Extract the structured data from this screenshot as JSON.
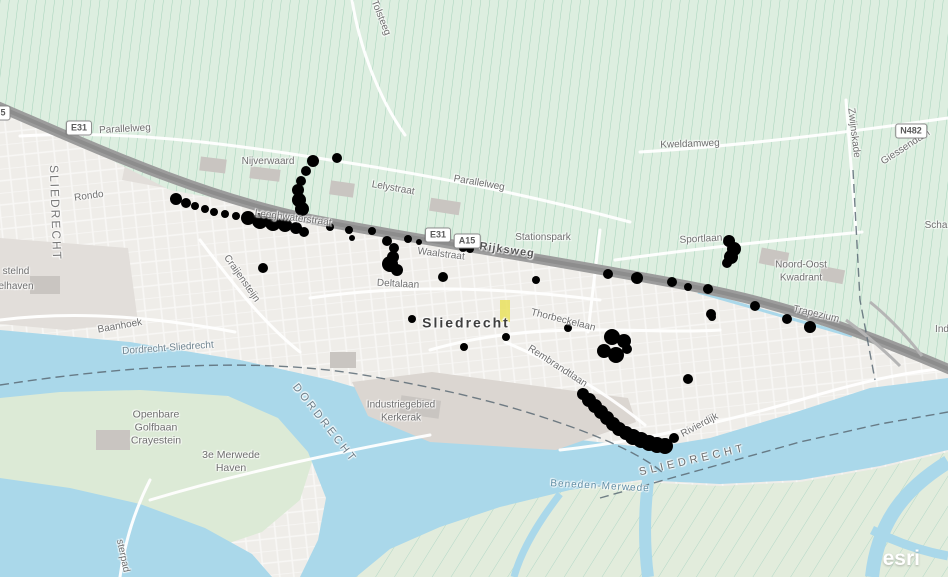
{
  "map": {
    "attribution": "esri",
    "colors": {
      "urban": "#efede9",
      "field": "#ddeee0",
      "fieldline": "#a5d2ba",
      "green2": "#dcead6",
      "islandgreen": "#e2ecdc",
      "islandline": "#8cc9b6",
      "water": "#aad8ea",
      "industrial": "#e2deda",
      "industrial2": "#d7d3cf",
      "highway": "#9c9c9c",
      "highwaycore": "#8d8d8d",
      "boundary": "#5c6b75",
      "dot": "#000000"
    },
    "badges": [
      {
        "id": "left-5",
        "label": "5",
        "x": 3,
        "y": 113
      },
      {
        "id": "e31-west",
        "label": "E31",
        "x": 79,
        "y": 128
      },
      {
        "id": "e31-east",
        "label": "E31",
        "x": 438,
        "y": 235
      },
      {
        "id": "a15",
        "label": "A15",
        "x": 467,
        "y": 241
      },
      {
        "id": "n482",
        "label": "N482",
        "x": 911,
        "y": 131
      }
    ],
    "labels": [
      {
        "id": "parallelweg-west",
        "text": "Parallelweg",
        "x": 125,
        "y": 130,
        "r": -3
      },
      {
        "id": "tolsteeg",
        "text": "Tolsteeg",
        "x": 380,
        "y": 18,
        "r": 68
      },
      {
        "id": "kweldamweg",
        "text": "Kweldamweg",
        "x": 690,
        "y": 145,
        "r": -2
      },
      {
        "id": "zwijnskade",
        "text": "Zwijnskade",
        "x": 853,
        "y": 133,
        "r": 83
      },
      {
        "id": "giessendam",
        "text": "Giessendam",
        "x": 906,
        "y": 148,
        "r": -33
      },
      {
        "id": "schaapweg",
        "text": "Scha",
        "x": 936,
        "y": 226,
        "r": 0
      },
      {
        "id": "industrieweg",
        "text": "Ind",
        "x": 942,
        "y": 330,
        "r": 0
      },
      {
        "id": "sliedrecht-west",
        "text": "SLIEDRECHT",
        "x": 55,
        "y": 213,
        "r": 88,
        "size": 12,
        "spacing": 2,
        "color": "#787878"
      },
      {
        "id": "rondo",
        "text": "Rondo",
        "x": 89,
        "y": 197,
        "r": -8
      },
      {
        "id": "nijverwaard",
        "text": "Nijverwaard",
        "x": 268,
        "y": 162,
        "r": 0
      },
      {
        "id": "lelystraat",
        "text": "Lelystraat",
        "x": 393,
        "y": 189,
        "r": 10
      },
      {
        "id": "parallelweg-east",
        "text": "Parallelweg",
        "x": 479,
        "y": 184,
        "r": 10
      },
      {
        "id": "leeghwaterstraat",
        "text": "Leeghwaterstraat",
        "x": 293,
        "y": 219,
        "r": 7
      },
      {
        "id": "rijksweg",
        "text": "Rijksweg",
        "x": 507,
        "y": 251,
        "r": 8,
        "size": 11,
        "bold": true,
        "color": "#565656",
        "spacing": 1
      },
      {
        "id": "stationspark",
        "text": "Stationspark",
        "x": 543,
        "y": 238,
        "r": 0
      },
      {
        "id": "waalstraat",
        "text": "Waalstraat",
        "x": 441,
        "y": 255,
        "r": 7
      },
      {
        "id": "sportlaan",
        "text": "Sportlaan",
        "x": 701,
        "y": 240,
        "r": -3
      },
      {
        "id": "noord-oost-kwadrant",
        "lines": [
          "Noord-Oost",
          "Kwadrant"
        ],
        "x": 801,
        "y": 272,
        "r": 0
      },
      {
        "id": "trapezium",
        "text": "Trapezium",
        "x": 816,
        "y": 315,
        "r": 13
      },
      {
        "id": "craijensteijn",
        "text": "Craijensteijn",
        "x": 241,
        "y": 279,
        "r": 55
      },
      {
        "id": "deltalaan",
        "text": "Deltalaan",
        "x": 398,
        "y": 285,
        "r": 3
      },
      {
        "id": "baanhoek",
        "text": "Baanhoek",
        "x": 120,
        "y": 327,
        "r": -10
      },
      {
        "id": "sliedrecht-city",
        "text": "Sliedrecht",
        "x": 466,
        "y": 323,
        "r": 0,
        "size": 14,
        "bold": true,
        "spacing": 2,
        "color": "#3f3f3f"
      },
      {
        "id": "thorbeckelaan",
        "text": "Thorbeckelaan",
        "x": 563,
        "y": 321,
        "r": 14
      },
      {
        "id": "rembrandtlaan",
        "text": "Rembrandtlaan",
        "x": 557,
        "y": 367,
        "r": 33
      },
      {
        "id": "rivierdijk",
        "text": "Rivierdijk",
        "x": 700,
        "y": 426,
        "r": -28
      },
      {
        "id": "oosteind",
        "text": "stelnd",
        "x": 16,
        "y": 272,
        "r": 0
      },
      {
        "id": "elhaven",
        "text": "elhaven",
        "x": 16,
        "y": 287,
        "r": 0
      },
      {
        "id": "golfbaan",
        "lines": [
          "Openbare",
          "Golfbaan",
          "Crayestein"
        ],
        "x": 156,
        "y": 428,
        "r": 0,
        "size": 10.5
      },
      {
        "id": "merwede-haven",
        "lines": [
          "3e Merwede",
          "Haven"
        ],
        "x": 231,
        "y": 462,
        "r": 0,
        "size": 10.5
      },
      {
        "id": "kerkerak",
        "lines": [
          "Industriegebied",
          "Kerkerak"
        ],
        "x": 401,
        "y": 412,
        "r": 0
      },
      {
        "id": "boundary-name",
        "text": "Dordrecht-Sliedrecht",
        "x": 168,
        "y": 349,
        "r": -4,
        "color": "#6f8490"
      },
      {
        "id": "dordrecht-water",
        "text": "DORDRECHT",
        "x": 324,
        "y": 424,
        "r": 52,
        "size": 11,
        "spacing": 3,
        "color": "#6d7d88"
      },
      {
        "id": "beneden-merwede",
        "text": "Beneden-Merwede",
        "x": 600,
        "y": 487,
        "r": 3,
        "color": "#5e8ca3",
        "spacing": 1
      },
      {
        "id": "sliedrecht-water",
        "text": "SLIEDRECHT",
        "x": 693,
        "y": 461,
        "r": -13,
        "size": 11,
        "spacing": 4,
        "color": "#6d6d6d"
      },
      {
        "id": "oosterpad",
        "text": "sterpad",
        "x": 122,
        "y": 556,
        "r": 78
      }
    ],
    "dots": [
      [
        176,
        199,
        6
      ],
      [
        186,
        203,
        5
      ],
      [
        195,
        206,
        4
      ],
      [
        205,
        209,
        4
      ],
      [
        214,
        212,
        4
      ],
      [
        225,
        214,
        4
      ],
      [
        236,
        216,
        4
      ],
      [
        248,
        218,
        7
      ],
      [
        260,
        221,
        8
      ],
      [
        273,
        223,
        8
      ],
      [
        285,
        225,
        7
      ],
      [
        296,
        228,
        6
      ],
      [
        304,
        232,
        5
      ],
      [
        313,
        161,
        6
      ],
      [
        306,
        171,
        5
      ],
      [
        301,
        181,
        5
      ],
      [
        298,
        190,
        6
      ],
      [
        299,
        200,
        7
      ],
      [
        302,
        209,
        7
      ],
      [
        337,
        158,
        5
      ],
      [
        330,
        227,
        4
      ],
      [
        349,
        230,
        4
      ],
      [
        372,
        231,
        4
      ],
      [
        352,
        238,
        3
      ],
      [
        387,
        241,
        5
      ],
      [
        394,
        248,
        5
      ],
      [
        393,
        257,
        6
      ],
      [
        390,
        264,
        8
      ],
      [
        397,
        270,
        6
      ],
      [
        408,
        239,
        4
      ],
      [
        419,
        242,
        3
      ],
      [
        443,
        277,
        5
      ],
      [
        463,
        248,
        4
      ],
      [
        470,
        249,
        4
      ],
      [
        412,
        319,
        4
      ],
      [
        464,
        347,
        4
      ],
      [
        506,
        337,
        4
      ],
      [
        536,
        280,
        4
      ],
      [
        263,
        268,
        5
      ],
      [
        608,
        274,
        5
      ],
      [
        637,
        278,
        6
      ],
      [
        672,
        282,
        5
      ],
      [
        688,
        287,
        4
      ],
      [
        708,
        289,
        5
      ],
      [
        755,
        306,
        5
      ],
      [
        787,
        319,
        5
      ],
      [
        810,
        327,
        6
      ],
      [
        712,
        317,
        4
      ],
      [
        729,
        241,
        6
      ],
      [
        734,
        249,
        7
      ],
      [
        731,
        257,
        7
      ],
      [
        727,
        263,
        5
      ],
      [
        612,
        337,
        8
      ],
      [
        624,
        341,
        7
      ],
      [
        604,
        351,
        7
      ],
      [
        616,
        355,
        8
      ],
      [
        627,
        349,
        5
      ],
      [
        568,
        328,
        4
      ],
      [
        711,
        314,
        5
      ],
      [
        688,
        379,
        5
      ],
      [
        583,
        394,
        6
      ],
      [
        589,
        400,
        7
      ],
      [
        595,
        406,
        7
      ],
      [
        601,
        412,
        7
      ],
      [
        607,
        418,
        7
      ],
      [
        613,
        424,
        7
      ],
      [
        619,
        429,
        7
      ],
      [
        626,
        433,
        7
      ],
      [
        633,
        437,
        8
      ],
      [
        641,
        440,
        8
      ],
      [
        649,
        443,
        8
      ],
      [
        657,
        445,
        8
      ],
      [
        665,
        446,
        8
      ],
      [
        674,
        438,
        5
      ]
    ]
  }
}
